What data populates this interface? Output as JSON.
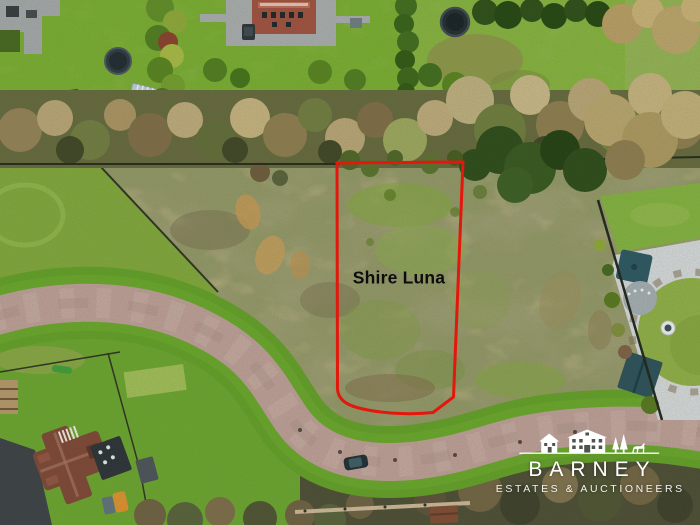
{
  "overlay": {
    "parcel_label": "Shire Luna",
    "outline_color": "#e4170c",
    "label_color": "#0d0d0d"
  },
  "logo": {
    "brand": "BARNEY",
    "tagline": "ESTATES & AUCTIONEERS",
    "text_color": "#ffffff",
    "icons": [
      "house-icon",
      "barn-icon",
      "pine-trees-icon",
      "horse-icon"
    ]
  },
  "scene": {
    "type": "aerial-photograph",
    "palette": {
      "garden_green": "#76a930",
      "rough_scrub": "#8e9464",
      "road_paving": "#b89b93",
      "verge_green": "#609c27",
      "winter_trees": "#a3925f",
      "dark_undergrowth": "#4b4c34",
      "roof_red": "#7b4635"
    }
  }
}
